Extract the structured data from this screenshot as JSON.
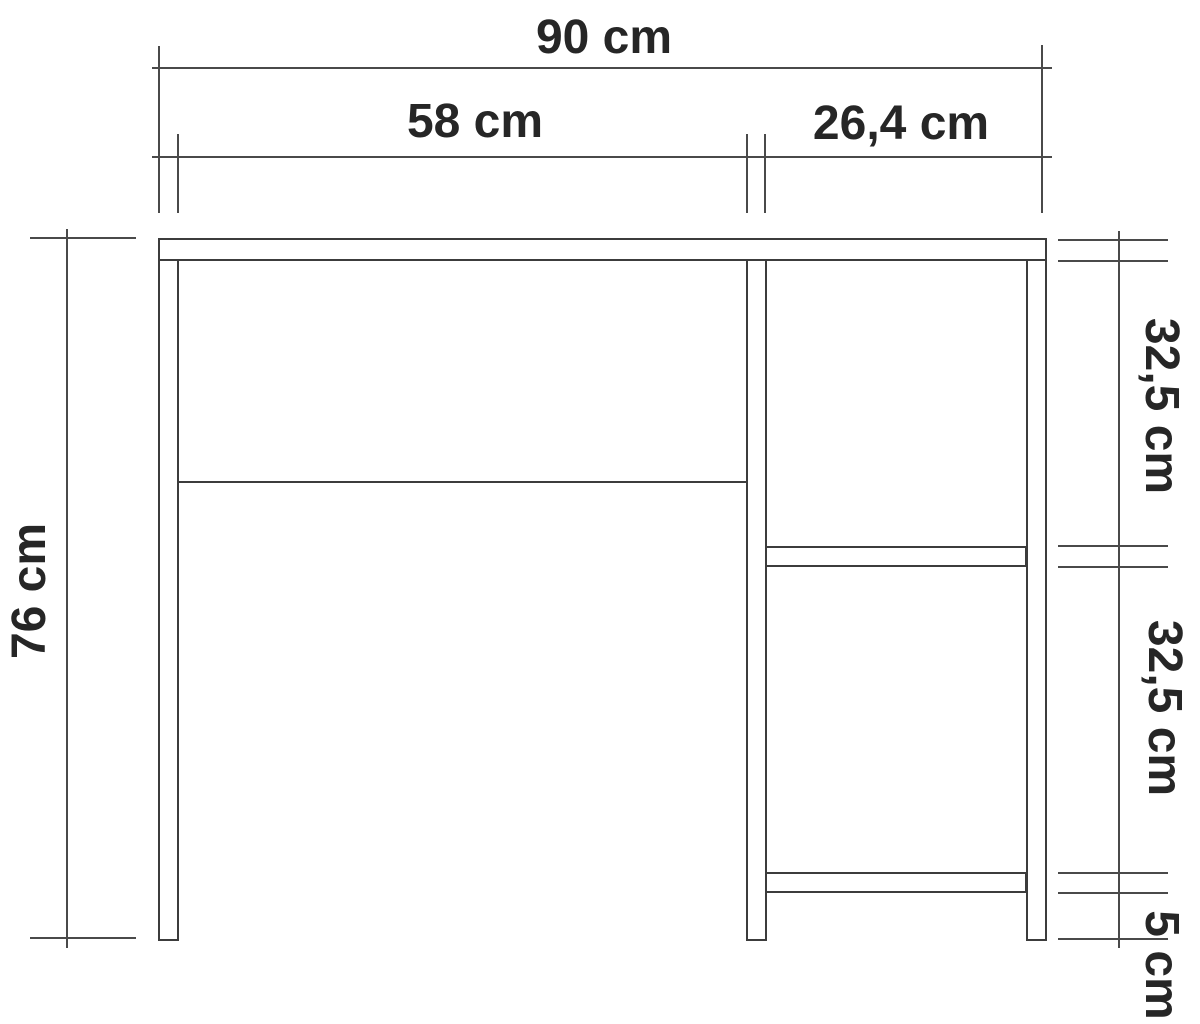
{
  "drawing": {
    "type": "furniture dimensioned technical drawing",
    "subject": "desk front elevation with side shelves",
    "labels": {
      "total_width": "90 cm",
      "left_opening_width": "58 cm",
      "right_opening_width": "26,4 cm",
      "total_height": "76 cm",
      "upper_shelf_gap": "32,5 cm",
      "lower_shelf_gap": "32,5 cm",
      "bottom_clearance": "5 cm"
    },
    "dimension_values_cm": {
      "total_width": 90,
      "left_opening_width": 58,
      "right_opening_width": 26.4,
      "total_height": 76,
      "upper_shelf_gap": 32.5,
      "lower_shelf_gap": 32.5,
      "bottom_clearance": 5
    },
    "colors": {
      "background": "#ffffff",
      "line": "#3c3c3c",
      "dimension_line": "#4a4a4a",
      "text": "#262626"
    }
  }
}
